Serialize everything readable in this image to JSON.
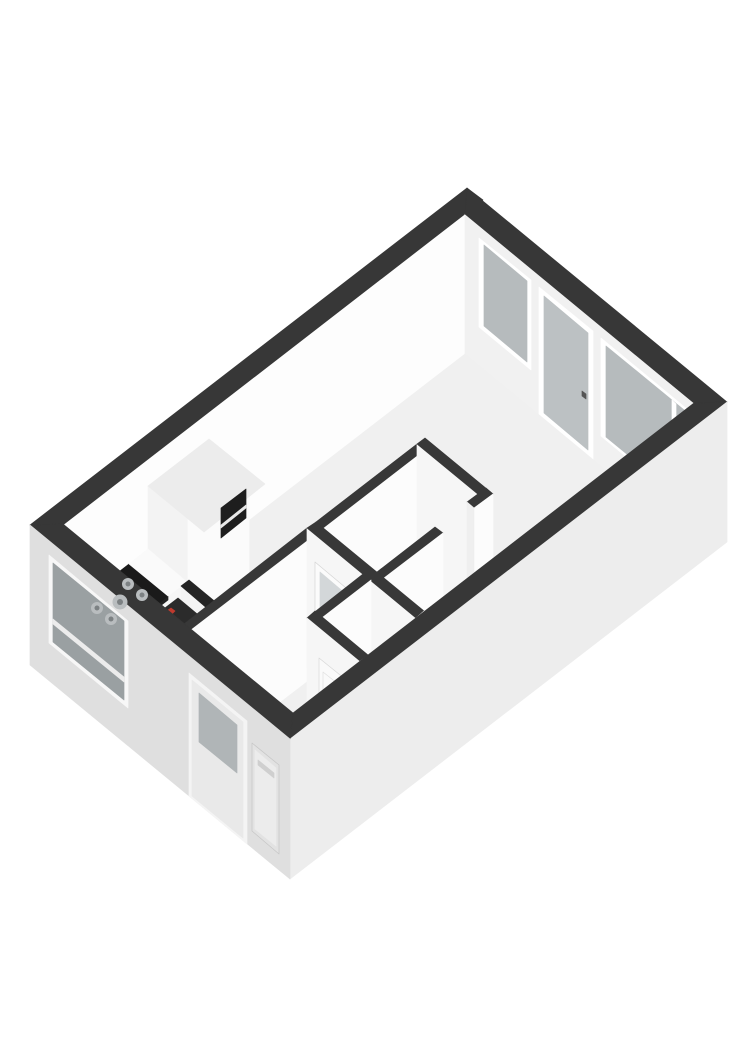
{
  "scene": {
    "name": "3d-floorplan-isometric-view",
    "width": 743,
    "height": 1050,
    "background": "#ffffff",
    "wall_cap_color": "#373737",
    "interior_wall_cap_color": "#383838",
    "floor_color": "#f0f0f0",
    "accent_red": "#c03a2e"
  },
  "shapes": {
    "polygons": [
      {
        "name": "wall-back-left-inner-face",
        "points": "63,524 465,214 465,354 63,664",
        "fill": "#fdfdfd"
      },
      {
        "name": "wall-back-left-cap",
        "points": "30,525 467,188 483,200 46,538",
        "fill": "#373737"
      },
      {
        "name": "wall-back-right-inner-face",
        "points": "465,214 694,403 694,543 465,354",
        "fill": "#f1f1f1"
      },
      {
        "name": "window-a-frame",
        "points": "479,238 531,280 531,370 479,327",
        "fill": "#ffffff"
      },
      {
        "name": "window-a-glass",
        "points": "484,245 527,281 527,362 484,326",
        "fill": "#b6bbbd"
      },
      {
        "name": "balcony-door-frame",
        "points": "539,287 593,331 593,459 539,414",
        "fill": "#ffffff"
      },
      {
        "name": "balcony-door-glass",
        "points": "544,296 588,333 588,450 544,413",
        "fill": "#bcc1c3"
      },
      {
        "name": "balcony-door-handle",
        "points": "582,391 586,394 586,399 582,396",
        "fill": "#555555"
      },
      {
        "name": "window-b-frame",
        "points": "601,338 693,414 693,512 601,436",
        "fill": "#ffffff"
      },
      {
        "name": "window-b-glass",
        "points": "606,346 689,414 689,505 606,437",
        "fill": "#b6bbbd"
      },
      {
        "name": "window-b-mullion",
        "points": "672,400 676,404 676,495 672,491",
        "fill": "#ffffff"
      },
      {
        "name": "wall-back-right-cap",
        "points": "467,188 727,402 694,403 465,214",
        "fill": "#373737"
      },
      {
        "name": "floor",
        "points": "63,664 465,354 694,543 293,853",
        "fill": "#f0f0f0"
      },
      {
        "name": "kitchen-cabinet-left-face",
        "points": "148,486 188,519 188,632 148,599",
        "fill": "#f3f3f3"
      },
      {
        "name": "kitchen-cabinet-front-face",
        "points": "188,519 249,472 249,585 188,632",
        "fill": "#fbfbfb"
      },
      {
        "name": "kitchen-cabinet-top-face",
        "points": "148,486 209,439 265,484 204,532",
        "fill": "#ececec"
      },
      {
        "name": "kitchen-cabinet-oven-inset",
        "points": "221,508 246,489 246,518 221,538",
        "fill": "#1e1e1e"
      },
      {
        "name": "kitchen-cabinet-oven-shelf-line",
        "points": "221,525 246,505 246,508 221,528",
        "fill": "#e8e8e8"
      },
      {
        "name": "kitchen-counter-front-face",
        "points": "106,644 187,582 187,631 106,694",
        "fill": "#f6f6f6"
      },
      {
        "name": "kitchen-counter-front-dark-strip",
        "points": "106,644 168,596 168,600 106,648",
        "fill": "#222222"
      },
      {
        "name": "kitchen-counter-left-end-face",
        "points": "67,612 106,644 106,694 67,661",
        "fill": "#ededed"
      },
      {
        "name": "kitchen-hob-dark-countertop",
        "points": "67,612 129,564 168,596 106,644",
        "fill": "#1a1a1a"
      },
      {
        "name": "kitchen-counter-white-top",
        "points": "129,564 148,549 187,582 168,596",
        "fill": "#fafafa"
      },
      {
        "name": "boiler-niche-right-wall-face",
        "points": "181,586 216,616 216,665 181,636",
        "fill": "#f4f4f4"
      },
      {
        "name": "boiler-niche-right-wall-cap",
        "points": "181,586 189,580 224,609 216,616",
        "fill": "#242424"
      },
      {
        "name": "boiler-top-face",
        "points": "157,614 178,598 202,618 181,634",
        "fill": "#2b2b2b"
      },
      {
        "name": "boiler-red-detail",
        "points": "165,612 171,608 175,611 170,616",
        "fill": "#c03a2e"
      },
      {
        "name": "boiler-front-face",
        "points": "157,614 181,634 181,680 157,661",
        "fill": "#f7f7f7"
      },
      {
        "name": "boiler-front-top-band",
        "points": "157,614 181,634 181,640 157,621",
        "fill": "#333333"
      },
      {
        "name": "boiler-side-face",
        "points": "181,634 202,618 202,664 181,680",
        "fill": "#e9e9e9"
      },
      {
        "name": "boiler-niche-back-wall-cap",
        "points": "169,640 217,603 224,609 176,646",
        "fill": "#242424"
      },
      {
        "name": "boiler-niche-back-wall-face",
        "points": "176,646 224,609 224,659 176,696",
        "fill": "#f1f1f1"
      },
      {
        "name": "boiler-niche-left-wall-cap",
        "points": "141,617 149,610 185,639 176,646",
        "fill": "#242424"
      },
      {
        "name": "boiler-niche-left-wall-face",
        "points": "141,616 176,646 176,696 141,666",
        "fill": "#f0f0f0"
      },
      {
        "name": "bathroom-top-wall-face",
        "points": "323,528 424,450 424,590 323,668",
        "fill": "#fcfcfc"
      },
      {
        "name": "bathroom-top-wall-cap",
        "points": "316,522 417,444 424,450 323,528",
        "fill": "#383838"
      },
      {
        "name": "bathroom-right-wall-face",
        "points": "417,444 485,500 485,640 417,584",
        "fill": "#f6f6f6"
      },
      {
        "name": "bathroom-right-wall-cap",
        "points": "417,444 425,438 493,494 485,500",
        "fill": "#383838"
      },
      {
        "name": "bathroom-bottom-wall-right-cap",
        "points": "467,502 486,488 493,494 474,508",
        "fill": "#383838"
      },
      {
        "name": "bathroom-bottom-wall-right-face",
        "points": "474,508 493,494 493,634 474,648",
        "fill": "#fcfcfc"
      },
      {
        "name": "bathroom-doorway-jamb",
        "points": "467,502 474,508 474,648 467,642",
        "fill": "#efefef"
      },
      {
        "name": "bathroom-bottom-wall-left-cap",
        "points": "377,572 435,527 443,533 384,578",
        "fill": "#383838"
      },
      {
        "name": "bathroom-bottom-wall-left-face",
        "points": "384,578 443,533 443,673 384,718",
        "fill": "#fcfcfc"
      },
      {
        "name": "hall-top-wall-cap",
        "points": "184,624 307,528 315,535 191,630",
        "fill": "#383838"
      },
      {
        "name": "hall-top-wall-face",
        "points": "191,630 315,535 315,675 191,770",
        "fill": "#fcfcfc"
      },
      {
        "name": "hall-door-wall-face",
        "points": "307,528 416,618 416,758 307,668",
        "fill": "#f6f6f6"
      },
      {
        "name": "interior-glass-door",
        "points": "315,562 358,598 358,710 315,674",
        "fill": "#fbfbfb",
        "stroke": "#d5d5d5"
      },
      {
        "name": "interior-glass-door-glass",
        "points": "320,572 353,600 353,655 320,627",
        "fill": "#d3d7d9"
      },
      {
        "name": "hall-door-wall-cap",
        "points": "307,528 316,522 424,611 416,618",
        "fill": "#383838"
      },
      {
        "name": "hall-door-wall-end-face",
        "points": "416,618 424,611 424,751 416,758",
        "fill": "#fcfcfc"
      },
      {
        "name": "toilet-top-wall-cap",
        "points": "307,618 363,574 371,580 314,624",
        "fill": "#383838"
      },
      {
        "name": "toilet-top-wall-face",
        "points": "314,624 371,580 371,720 314,764",
        "fill": "#fcfcfc"
      },
      {
        "name": "toilet-left-wall-cap",
        "points": "307,618 315,611 368,655 359,661",
        "fill": "#383838"
      },
      {
        "name": "toilet-left-wall-face",
        "points": "307,618 359,661 359,801 307,758",
        "fill": "#f6f6f6"
      },
      {
        "name": "toilet-door",
        "points": "319,658 355,687 355,798 319,768",
        "fill": "#fafafa",
        "stroke": "#d8d8d8"
      },
      {
        "name": "toilet-door-panel",
        "points": "323,672 352,695 352,781 323,758",
        "fill": "none",
        "stroke": "#e0e0e0"
      },
      {
        "name": "wall-front-right-cap",
        "points": "293,713 694,403 727,402 290,739",
        "fill": "#373737"
      },
      {
        "name": "wall-front-right-outer-face",
        "points": "290,739 727,402 727,542 290,879",
        "fill": "#ededed"
      },
      {
        "name": "wall-front-left-cap",
        "points": "30,525 63,524 293,713 290,739",
        "fill": "#373737"
      },
      {
        "name": "wall-front-left-outer-face",
        "points": "30,525 290,739 290,879 30,665",
        "fill": "#dfdfdf"
      },
      {
        "name": "exterior-window-frame",
        "points": "49,555 128,621 128,708 49,643",
        "fill": "#f7f7f7"
      },
      {
        "name": "exterior-window-glass",
        "points": "53,563 124,621 124,700 53,642",
        "fill": "#9aa0a2"
      },
      {
        "name": "exterior-window-rail",
        "points": "53,619 124,677 124,682 53,624",
        "fill": "#ececec"
      },
      {
        "name": "front-door-frame",
        "points": "189,673 247,721 247,844 189,796",
        "fill": "#f4f4f4"
      },
      {
        "name": "front-door-leaf",
        "points": "192,680 243,722 243,838 192,796",
        "fill": "#e9e9e9"
      },
      {
        "name": "front-door-glass",
        "points": "199,693 237,725 237,773 199,742",
        "fill": "#b0b5b7"
      },
      {
        "name": "service-hatch-recess",
        "points": "252,743 279,765 279,854 252,831",
        "fill": "#e2e2e2",
        "stroke": "#c6c6c6"
      },
      {
        "name": "service-hatch-panel",
        "points": "255,750 276,768 276,846 255,829",
        "fill": "#ececec"
      },
      {
        "name": "service-hatch-slot",
        "points": "258,760 274,773 274,778 258,765",
        "fill": "#cfcfcf"
      }
    ],
    "circles": [
      {
        "name": "hob-burner-1",
        "cx": 97,
        "cy": 608,
        "r": 6,
        "fill": "#b9bdbf"
      },
      {
        "name": "hob-burner-1-cap",
        "cx": 97,
        "cy": 608,
        "r": 2.5,
        "fill": "#7c8183"
      },
      {
        "name": "hob-burner-2",
        "cx": 111,
        "cy": 619,
        "r": 6,
        "fill": "#b9bdbf"
      },
      {
        "name": "hob-burner-2-cap",
        "cx": 111,
        "cy": 619,
        "r": 2.5,
        "fill": "#7c8183"
      },
      {
        "name": "hob-burner-3",
        "cx": 120,
        "cy": 602,
        "r": 7.5,
        "fill": "#b9bdbf"
      },
      {
        "name": "hob-burner-3-cap",
        "cx": 120,
        "cy": 602,
        "r": 3,
        "fill": "#7c8183"
      },
      {
        "name": "hob-burner-4",
        "cx": 128,
        "cy": 584,
        "r": 6,
        "fill": "#b9bdbf"
      },
      {
        "name": "hob-burner-4-cap",
        "cx": 128,
        "cy": 584,
        "r": 2.5,
        "fill": "#7c8183"
      },
      {
        "name": "hob-burner-5",
        "cx": 142,
        "cy": 595,
        "r": 6,
        "fill": "#b9bdbf"
      },
      {
        "name": "hob-burner-5-cap",
        "cx": 142,
        "cy": 595,
        "r": 2.5,
        "fill": "#7c8183"
      }
    ]
  }
}
